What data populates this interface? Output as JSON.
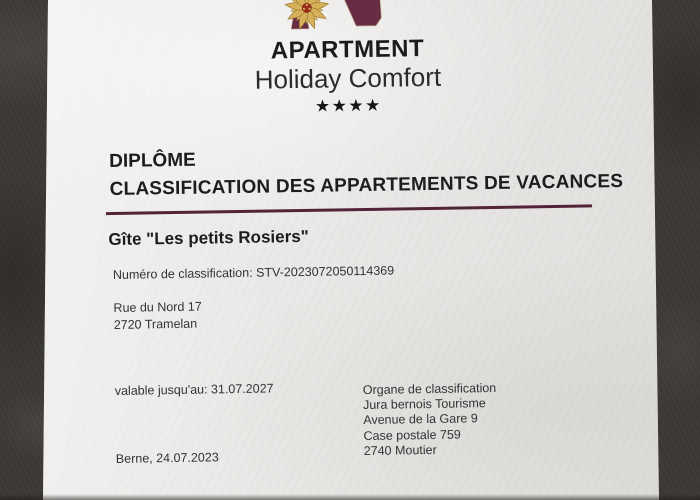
{
  "photo": {
    "background_color": "#3d3a35",
    "paper_color": "#e9e8e6"
  },
  "certificate": {
    "logo": {
      "icon": "edelweiss-a-monogram",
      "brand": "APARTMENT",
      "tagline": "Holiday Comfort",
      "stars": "★★★★",
      "colors": {
        "maroon": "#682d44",
        "gold": "#d6b159",
        "flower_center": "#9c2c1c"
      }
    },
    "title": "DIPLÔME",
    "subtitle": "CLASSIFICATION DES APPARTEMENTS DE VACANCES",
    "divider_color": "#532438",
    "property_name": "Gîte \"Les petits Rosiers\"",
    "classification_number": "Numéro de classification: STV-2023072050114369",
    "property_address": {
      "line1": "Rue du Nord 17",
      "line2": "2720 Tramelan"
    },
    "validity": "valable jusqu'au: 31.07.2027",
    "issued": "Berne, 24.07.2023",
    "classification_body": {
      "title": "Organe de classification",
      "name": "Jura bernois Tourisme",
      "street": "Avenue de la Gare 9",
      "po_box": "Case postale 759",
      "city": "2740 Moutier"
    }
  }
}
